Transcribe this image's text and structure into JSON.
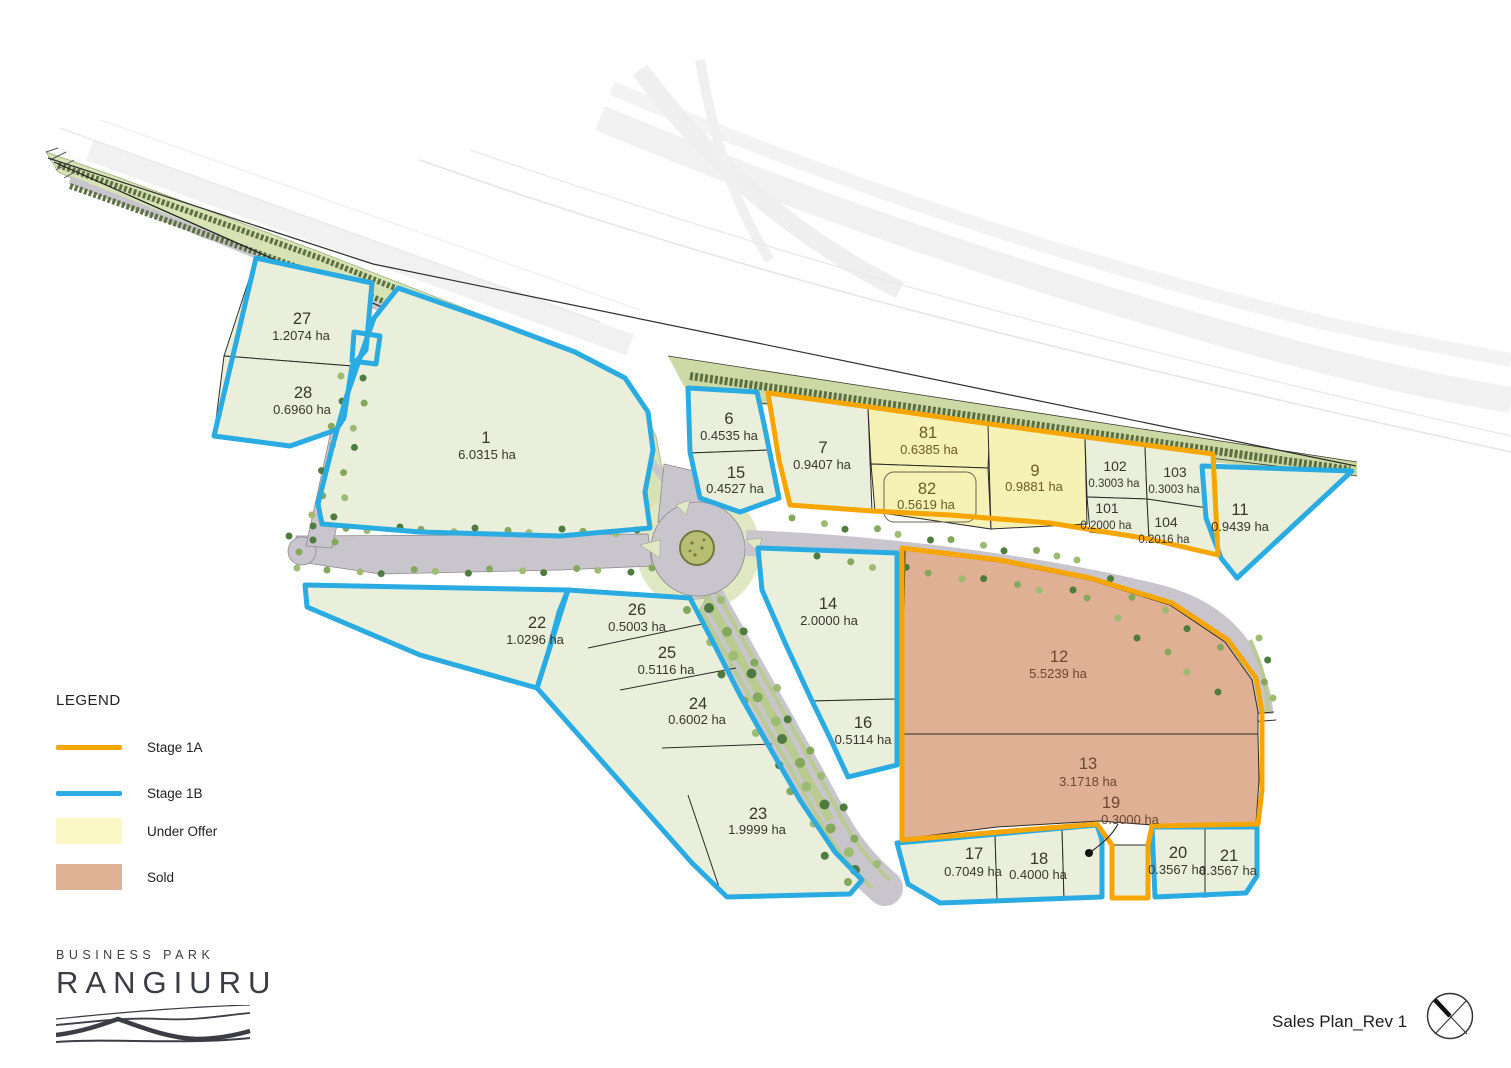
{
  "title": "Sales Plan_Rev 1",
  "legend": {
    "title": "LEGEND",
    "items": [
      {
        "label": "Stage 1A",
        "swatch": "line",
        "color": "#F7A600"
      },
      {
        "label": "Stage 1B",
        "swatch": "line",
        "color": "#2AABE2"
      },
      {
        "label": "Under Offer",
        "swatch": "rect",
        "color": "#FBF8C5"
      },
      {
        "label": "Sold",
        "swatch": "rect",
        "color": "#DFB295"
      }
    ]
  },
  "logo": {
    "line1": "BUSINESS PARK",
    "line2": "RANGIURU"
  },
  "footer": {
    "title": "Sales Plan_Rev 1"
  },
  "colors": {
    "stage1a": "#F7A600",
    "stage1b": "#2AABE2",
    "under_offer_fill": "#F6F1B4",
    "sold_fill": "#DFB093",
    "lot_fill": "#E9EFDA",
    "road_fill": "#C9C5CC",
    "corridor_fill": "#D8E3B5",
    "label_available": "#39362D",
    "label_under_offer": "#6A5C25",
    "label_sold": "#6B4832"
  },
  "lots": [
    {
      "id": "27",
      "area": "1.2074 ha",
      "status": "available",
      "nx": 302,
      "ny": 324,
      "ax": 301,
      "ay": 340
    },
    {
      "id": "28",
      "area": "0.6960 ha",
      "status": "available",
      "nx": 303,
      "ny": 398,
      "ax": 302,
      "ay": 414
    },
    {
      "id": "1",
      "area": "6.0315 ha",
      "status": "available",
      "nx": 486,
      "ny": 443,
      "ax": 487,
      "ay": 459
    },
    {
      "id": "6",
      "area": "0.4535 ha",
      "status": "available",
      "nx": 729,
      "ny": 424,
      "ax": 729,
      "ay": 440
    },
    {
      "id": "15",
      "area": "0.4527 ha",
      "status": "available",
      "nx": 736,
      "ny": 478,
      "ax": 735,
      "ay": 493
    },
    {
      "id": "7",
      "area": "0.9407 ha",
      "status": "available",
      "nx": 823,
      "ny": 453,
      "ax": 822,
      "ay": 469
    },
    {
      "id": "81",
      "area": "0.6385 ha",
      "status": "under_offer",
      "nx": 928,
      "ny": 438,
      "ax": 929,
      "ay": 454
    },
    {
      "id": "82",
      "area": "0.5619 ha",
      "status": "under_offer",
      "nx": 927,
      "ny": 494,
      "ax": 926,
      "ay": 509
    },
    {
      "id": "9",
      "area": "0.9881 ha",
      "status": "under_offer",
      "nx": 1035,
      "ny": 476,
      "ax": 1034,
      "ay": 491
    },
    {
      "id": "102",
      "area": "0.3003 ha",
      "status": "available",
      "small": true,
      "nx": 1115,
      "ny": 471,
      "ax": 1114,
      "ay": 487
    },
    {
      "id": "103",
      "area": "0.3003 ha",
      "status": "available",
      "small": true,
      "nx": 1175,
      "ny": 477,
      "ax": 1174,
      "ay": 493
    },
    {
      "id": "101",
      "area": "0.2000 ha",
      "status": "available",
      "small": true,
      "nx": 1107,
      "ny": 513,
      "ax": 1106,
      "ay": 529
    },
    {
      "id": "104",
      "area": "0.2016 ha",
      "status": "available",
      "small": true,
      "nx": 1166,
      "ny": 527,
      "ax": 1164,
      "ay": 543
    },
    {
      "id": "11",
      "area": "0.9439 ha",
      "status": "available",
      "nx": 1240,
      "ny": 515,
      "ax": 1240,
      "ay": 531
    },
    {
      "id": "22",
      "area": "1.0296 ha",
      "status": "available",
      "nx": 537,
      "ny": 628,
      "ax": 535,
      "ay": 644
    },
    {
      "id": "26",
      "area": "0.5003 ha",
      "status": "available",
      "nx": 637,
      "ny": 615,
      "ax": 637,
      "ay": 631
    },
    {
      "id": "25",
      "area": "0.5116 ha",
      "status": "available",
      "nx": 667,
      "ny": 658,
      "ax": 666,
      "ay": 674
    },
    {
      "id": "24",
      "area": "0.6002 ha",
      "status": "available",
      "nx": 698,
      "ny": 709,
      "ax": 697,
      "ay": 724
    },
    {
      "id": "14",
      "area": "2.0000 ha",
      "status": "available",
      "nx": 828,
      "ny": 609,
      "ax": 829,
      "ay": 625
    },
    {
      "id": "16",
      "area": "0.5114 ha",
      "status": "available",
      "nx": 863,
      "ny": 728,
      "ax": 863,
      "ay": 744
    },
    {
      "id": "12",
      "area": "5.5239 ha",
      "status": "sold",
      "nx": 1059,
      "ny": 662,
      "ax": 1058,
      "ay": 678
    },
    {
      "id": "13",
      "area": "3.1718 ha",
      "status": "sold",
      "nx": 1088,
      "ny": 769,
      "ax": 1088,
      "ay": 786
    },
    {
      "id": "19",
      "area": "0.3000 ha",
      "status": "available",
      "tone": "sold",
      "nx": 1111,
      "ny": 808,
      "ax": 1130,
      "ay": 824
    },
    {
      "id": "23",
      "area": "1.9999 ha",
      "status": "available",
      "nx": 758,
      "ny": 819,
      "ax": 757,
      "ay": 834
    },
    {
      "id": "17",
      "area": "0.7049 ha",
      "status": "available",
      "nx": 974,
      "ny": 859,
      "ax": 973,
      "ay": 876
    },
    {
      "id": "18",
      "area": "0.4000 ha",
      "status": "available",
      "nx": 1039,
      "ny": 864,
      "ax": 1038,
      "ay": 879
    },
    {
      "id": "20",
      "area": "0.3567 ha",
      "status": "available",
      "nx": 1178,
      "ny": 858,
      "ax": 1177,
      "ay": 874
    },
    {
      "id": "21",
      "area": "0.3567 ha",
      "status": "available",
      "nx": 1229,
      "ny": 861,
      "ax": 1228,
      "ay": 875
    }
  ]
}
